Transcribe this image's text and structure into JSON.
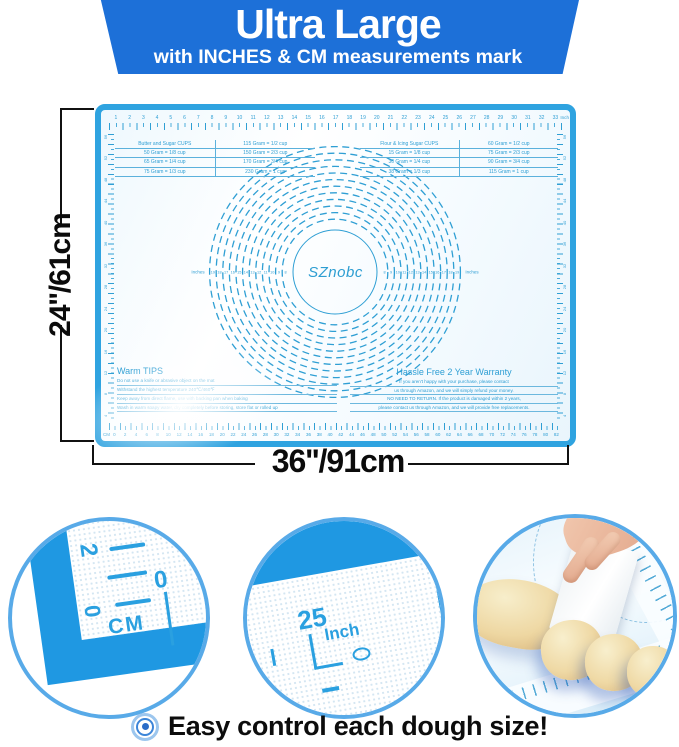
{
  "banner": {
    "title": "Ultra Large",
    "subtitle": "with INCHES & CM measurements mark",
    "bg_color": "#1d70d8"
  },
  "mat": {
    "brand": "SZnobc",
    "marking_color": "#2f9fd4",
    "frame_color": "#2fa3e0",
    "top_ruler": {
      "unit": "Inch",
      "start": 1,
      "end": 33,
      "step": 1
    },
    "bottom_ruler": {
      "unit": "CM",
      "start": 0,
      "end": 82,
      "step": 2
    },
    "side_ruler": {
      "start": 4,
      "end": 56,
      "step": 4
    },
    "tables": [
      {
        "rows": [
          [
            "Butter and Sugar CUPS",
            "115 Gram = 1/2 cup"
          ],
          [
            "50 Gram = 1/8 cup",
            "150 Gram = 2/3 cup"
          ],
          [
            "65 Gram = 1/4 cup",
            "170 Gram = 3/4 cup"
          ],
          [
            "75 Gram = 1/3 cup",
            "230 Gram = 1 cup"
          ]
        ]
      },
      {
        "rows": [
          [
            "Flour & Icing Sugar CUPS",
            "60 Gram = 1/2 cup"
          ],
          [
            "15 Gram = 1/8 cup",
            "75 Gram = 2/3 cup"
          ],
          [
            "30 Gram = 1/4 cup",
            "90 Gram = 3/4 cup"
          ],
          [
            "38 Gram = 1/3 cup",
            "115 Gram = 1 cup"
          ]
        ]
      }
    ],
    "rings": {
      "label": "Inches",
      "min_diameter": 8,
      "max_diameter": 19
    },
    "warm_tips": {
      "title": "Warm TIPS",
      "lines": [
        "Do not use a knife or abrasive object on the mat",
        "Withstand the highest temperature 240℃/460℉",
        "Keep away from direct flame, use with backing pan when baking",
        "Wash in warm soapy water, dry completely before storing, store flat or rolled up"
      ]
    },
    "warranty": {
      "title": "Hassle Free 2 Year Warranty",
      "lines": [
        "If you aren't happy with your purchase, please contact",
        "us through Amazon, and we will simply refund your money.",
        "NO NEED TO RETURN. If the product is damaged within 2 years,",
        "please contact us through Amazon, and we will provide free replacements."
      ]
    }
  },
  "dimensions": {
    "height_label": "24''/61cm",
    "width_label": "36''/91cm"
  },
  "insets": {
    "cm_closeup": {
      "top_number": "2",
      "side_number": "0",
      "unit": "CM",
      "corner_number": "0"
    },
    "inch_closeup": {
      "number": "25",
      "unit": "Inch"
    }
  },
  "caption": "Easy control each dough size!"
}
